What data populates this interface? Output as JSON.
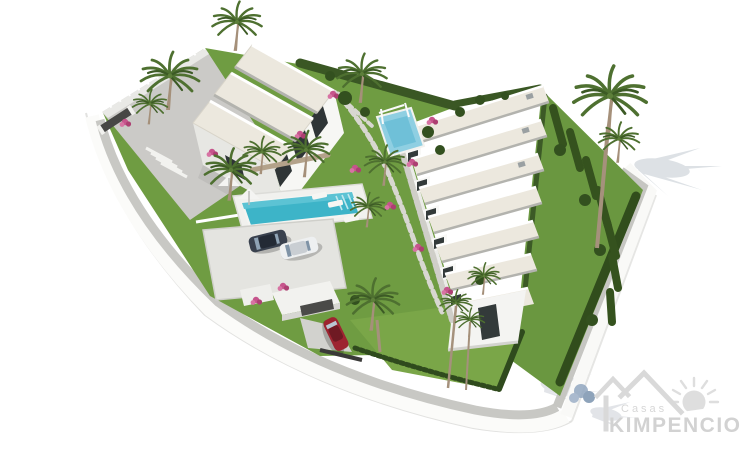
{
  "image": {
    "type": "3d-architectural-render",
    "view": "aerial-isometric",
    "background": "#ffffff",
    "subject": "Residential development: two white apartment blocks with cream pitched roofs, communal turquoise pool, kids splash pool with pergola, landscaped gardens with palm trees and bougainvillea, hedged private gardens, parking pad with two cars, carport with red car, curved white perimeter wall and grey sidewalk"
  },
  "watermark": {
    "brand_top": "Casas",
    "brand_main": "KIMPENCIO",
    "color": "#d5d5d5",
    "elements": [
      "house-roofline",
      "sun"
    ]
  },
  "palette": {
    "background": "#ffffff",
    "roof_cream": "#ece8de",
    "wall_white": "#f7f7f4",
    "wall_shade": "#e7e7e3",
    "grass": "#6f9c42",
    "lawn_bright": "#7aa648",
    "hedge_dark": "#35521e",
    "pool_turquoise": "#3db4c8",
    "splash_pool_blue": "#8fcfe2",
    "sidewalk_grey": "#c8c8c4",
    "deck_grey": "#cbcac7",
    "car_dark": "#39414e",
    "car_white": "#eef0f1",
    "car_red": "#9d2430",
    "flower_pink": "#c6548c",
    "shadow_blue_grey": "#d2d8dd",
    "logo_grey": "#d9d9d9"
  },
  "scene": {
    "building_a_roof_sections": 3,
    "building_b_roof_sections": 7,
    "pools": [
      "main communal pool",
      "small splash pool with pergola"
    ],
    "cars_visible": [
      "dark grey",
      "white",
      "red"
    ],
    "vegetation": [
      "palm trees",
      "cypress hedges",
      "bougainvillea",
      "lawns"
    ]
  }
}
